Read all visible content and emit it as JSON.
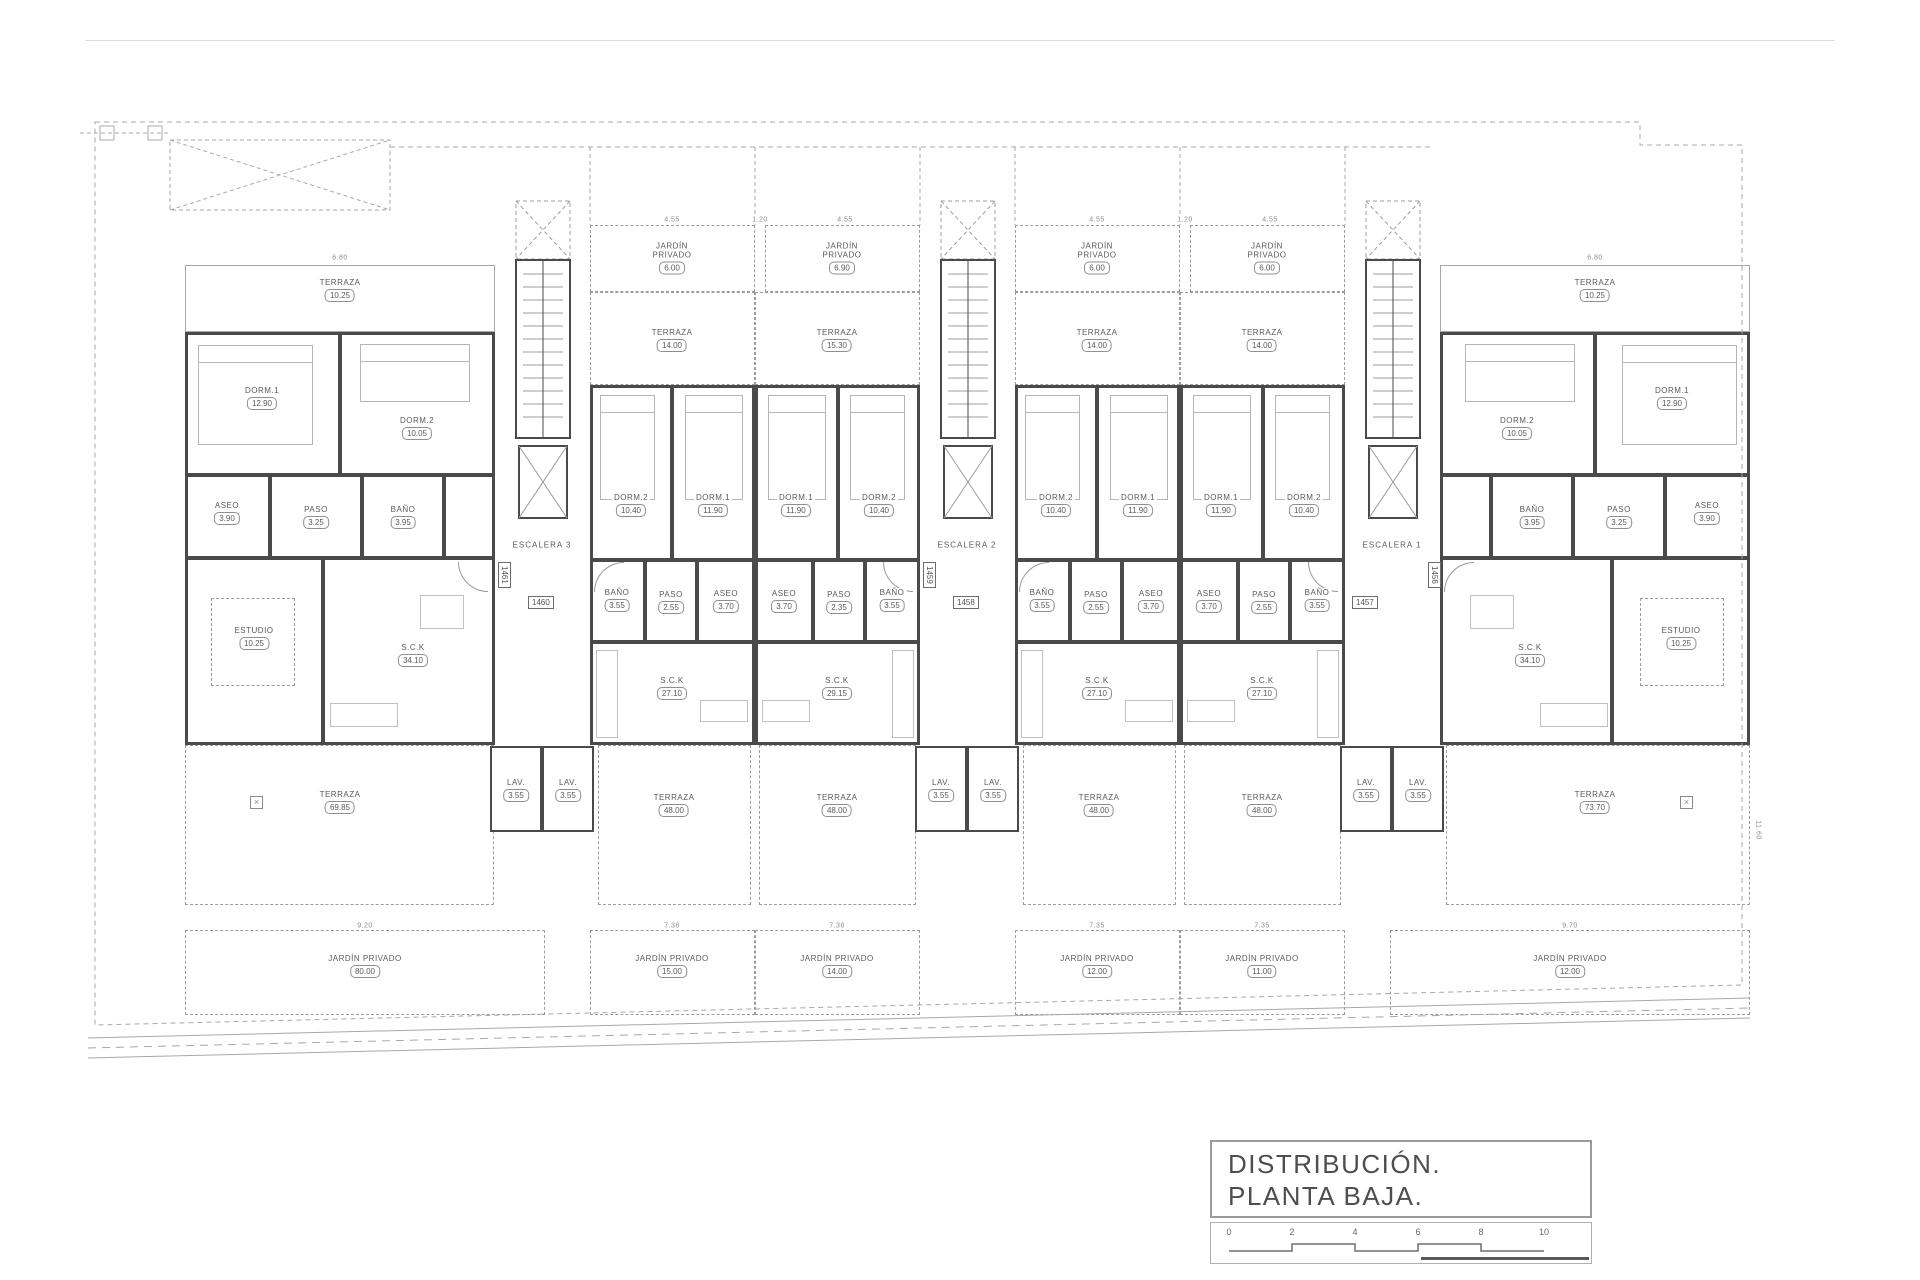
{
  "sheet": {
    "title_line1": "DISTRIBUCIÓN.",
    "title_line2": "PLANTA BAJA.",
    "scale_ticks": [
      "0",
      "2",
      "4",
      "6",
      "8",
      "10"
    ],
    "line_color": "#4a4a4a",
    "light_line_color": "#9c9c9c"
  },
  "stairs": {
    "s3": "ESCALERA 3",
    "s2": "ESCALERA 2",
    "s1": "ESCALERA 1"
  },
  "badges": {
    "b1461": "1461",
    "b1460": "1460",
    "b1459": "1459",
    "b1458": "1458",
    "b1457": "1457",
    "b1456": "1456"
  },
  "common": {
    "lav": {
      "n": "LAV.",
      "a": "3.55"
    }
  },
  "dims": {
    "u1_top": "6.80",
    "u6_top": "6.80",
    "mid_top": "4.55",
    "gap": "1.20",
    "u1_bot": "9.20",
    "u2_bot": "7.38",
    "u3_bot": "7.38",
    "u4_bot": "7.35",
    "u5_bot": "7.35",
    "u6_bot": "9.70",
    "side_right": "11.60"
  },
  "units": {
    "u1": {
      "terraza_top": {
        "n": "TERRAZA",
        "a": "10.25"
      },
      "dorm1": {
        "n": "DORM.1",
        "a": "12.90"
      },
      "dorm2": {
        "n": "DORM.2",
        "a": "10.05"
      },
      "aseo": {
        "n": "ASEO",
        "a": "3.90"
      },
      "paso": {
        "n": "PASO",
        "a": "3.25"
      },
      "bano": {
        "n": "BAÑO",
        "a": "3.95"
      },
      "estudio": {
        "n": "ESTUDIO",
        "a": "10.25"
      },
      "sck": {
        "n": "S.C.K",
        "a": "34.10"
      },
      "terraza": {
        "n": "TERRAZA",
        "a": "69.85"
      },
      "jardin": {
        "n": "JARDÍN PRIVADO",
        "a": "80.00"
      }
    },
    "u2": {
      "jardin_top": {
        "n": "JARDÍN PRIVADO",
        "a": "6.00"
      },
      "terraza_top": {
        "n": "TERRAZA",
        "a": "14.00"
      },
      "dorm2": {
        "n": "DORM.2",
        "a": "10.40"
      },
      "dorm1": {
        "n": "DORM.1",
        "a": "11.90"
      },
      "bano": {
        "n": "BAÑO",
        "a": "3.55"
      },
      "paso": {
        "n": "PASO",
        "a": "2.55"
      },
      "aseo": {
        "n": "ASEO",
        "a": "3.70"
      },
      "sck": {
        "n": "S.C.K",
        "a": "27.10"
      },
      "terraza": {
        "n": "TERRAZA",
        "a": "48.00"
      },
      "jardin": {
        "n": "JARDÍN PRIVADO",
        "a": "15.00"
      }
    },
    "u3": {
      "jardin_top": {
        "n": "JARDÍN PRIVADO",
        "a": "6.90"
      },
      "terraza_top": {
        "n": "TERRAZA",
        "a": "15.30"
      },
      "dorm1": {
        "n": "DORM.1",
        "a": "11.90"
      },
      "dorm2": {
        "n": "DORM.2",
        "a": "10.40"
      },
      "aseo": {
        "n": "ASEO",
        "a": "3.70"
      },
      "paso": {
        "n": "PASO",
        "a": "2.35"
      },
      "bano": {
        "n": "BAÑO",
        "a": "3.55"
      },
      "sck": {
        "n": "S.C.K",
        "a": "29.15"
      },
      "terraza": {
        "n": "TERRAZA",
        "a": "48.00"
      },
      "jardin": {
        "n": "JARDÍN PRIVADO",
        "a": "14.00"
      }
    },
    "u4": {
      "jardin_top": {
        "n": "JARDÍN PRIVADO",
        "a": "6.00"
      },
      "terraza_top": {
        "n": "TERRAZA",
        "a": "14.00"
      },
      "dorm2": {
        "n": "DORM.2",
        "a": "10.40"
      },
      "dorm1": {
        "n": "DORM.1",
        "a": "11.90"
      },
      "bano": {
        "n": "BAÑO",
        "a": "3.55"
      },
      "paso": {
        "n": "PASO",
        "a": "2.55"
      },
      "aseo": {
        "n": "ASEO",
        "a": "3.70"
      },
      "sck": {
        "n": "S.C.K",
        "a": "27.10"
      },
      "terraza": {
        "n": "TERRAZA",
        "a": "48.00"
      },
      "jardin": {
        "n": "JARDÍN PRIVADO",
        "a": "12.00"
      }
    },
    "u5": {
      "jardin_top": {
        "n": "JARDÍN PRIVADO",
        "a": "6.00"
      },
      "terraza_top": {
        "n": "TERRAZA",
        "a": "14.00"
      },
      "dorm1": {
        "n": "DORM.1",
        "a": "11.90"
      },
      "dorm2": {
        "n": "DORM.2",
        "a": "10.40"
      },
      "aseo": {
        "n": "ASEO",
        "a": "3.70"
      },
      "paso": {
        "n": "PASO",
        "a": "2.55"
      },
      "bano": {
        "n": "BAÑO",
        "a": "3.55"
      },
      "sck": {
        "n": "S.C.K",
        "a": "27.10"
      },
      "terraza": {
        "n": "TERRAZA",
        "a": "48.00"
      },
      "jardin": {
        "n": "JARDÍN PRIVADO",
        "a": "11.00"
      }
    },
    "u6": {
      "terraza_top": {
        "n": "TERRAZA",
        "a": "10.25"
      },
      "dorm2": {
        "n": "DORM.2",
        "a": "10.05"
      },
      "dorm1": {
        "n": "DORM.1",
        "a": "12.90"
      },
      "bano": {
        "n": "BAÑO",
        "a": "3.95"
      },
      "paso": {
        "n": "PASO",
        "a": "3.25"
      },
      "aseo": {
        "n": "ASEO",
        "a": "3.90"
      },
      "estudio": {
        "n": "ESTUDIO",
        "a": "10.25"
      },
      "sck": {
        "n": "S.C.K",
        "a": "34.10"
      },
      "terraza": {
        "n": "TERRAZA",
        "a": "73.70"
      },
      "jardin": {
        "n": "JARDÍN PRIVADO",
        "a": "12.00"
      }
    }
  }
}
